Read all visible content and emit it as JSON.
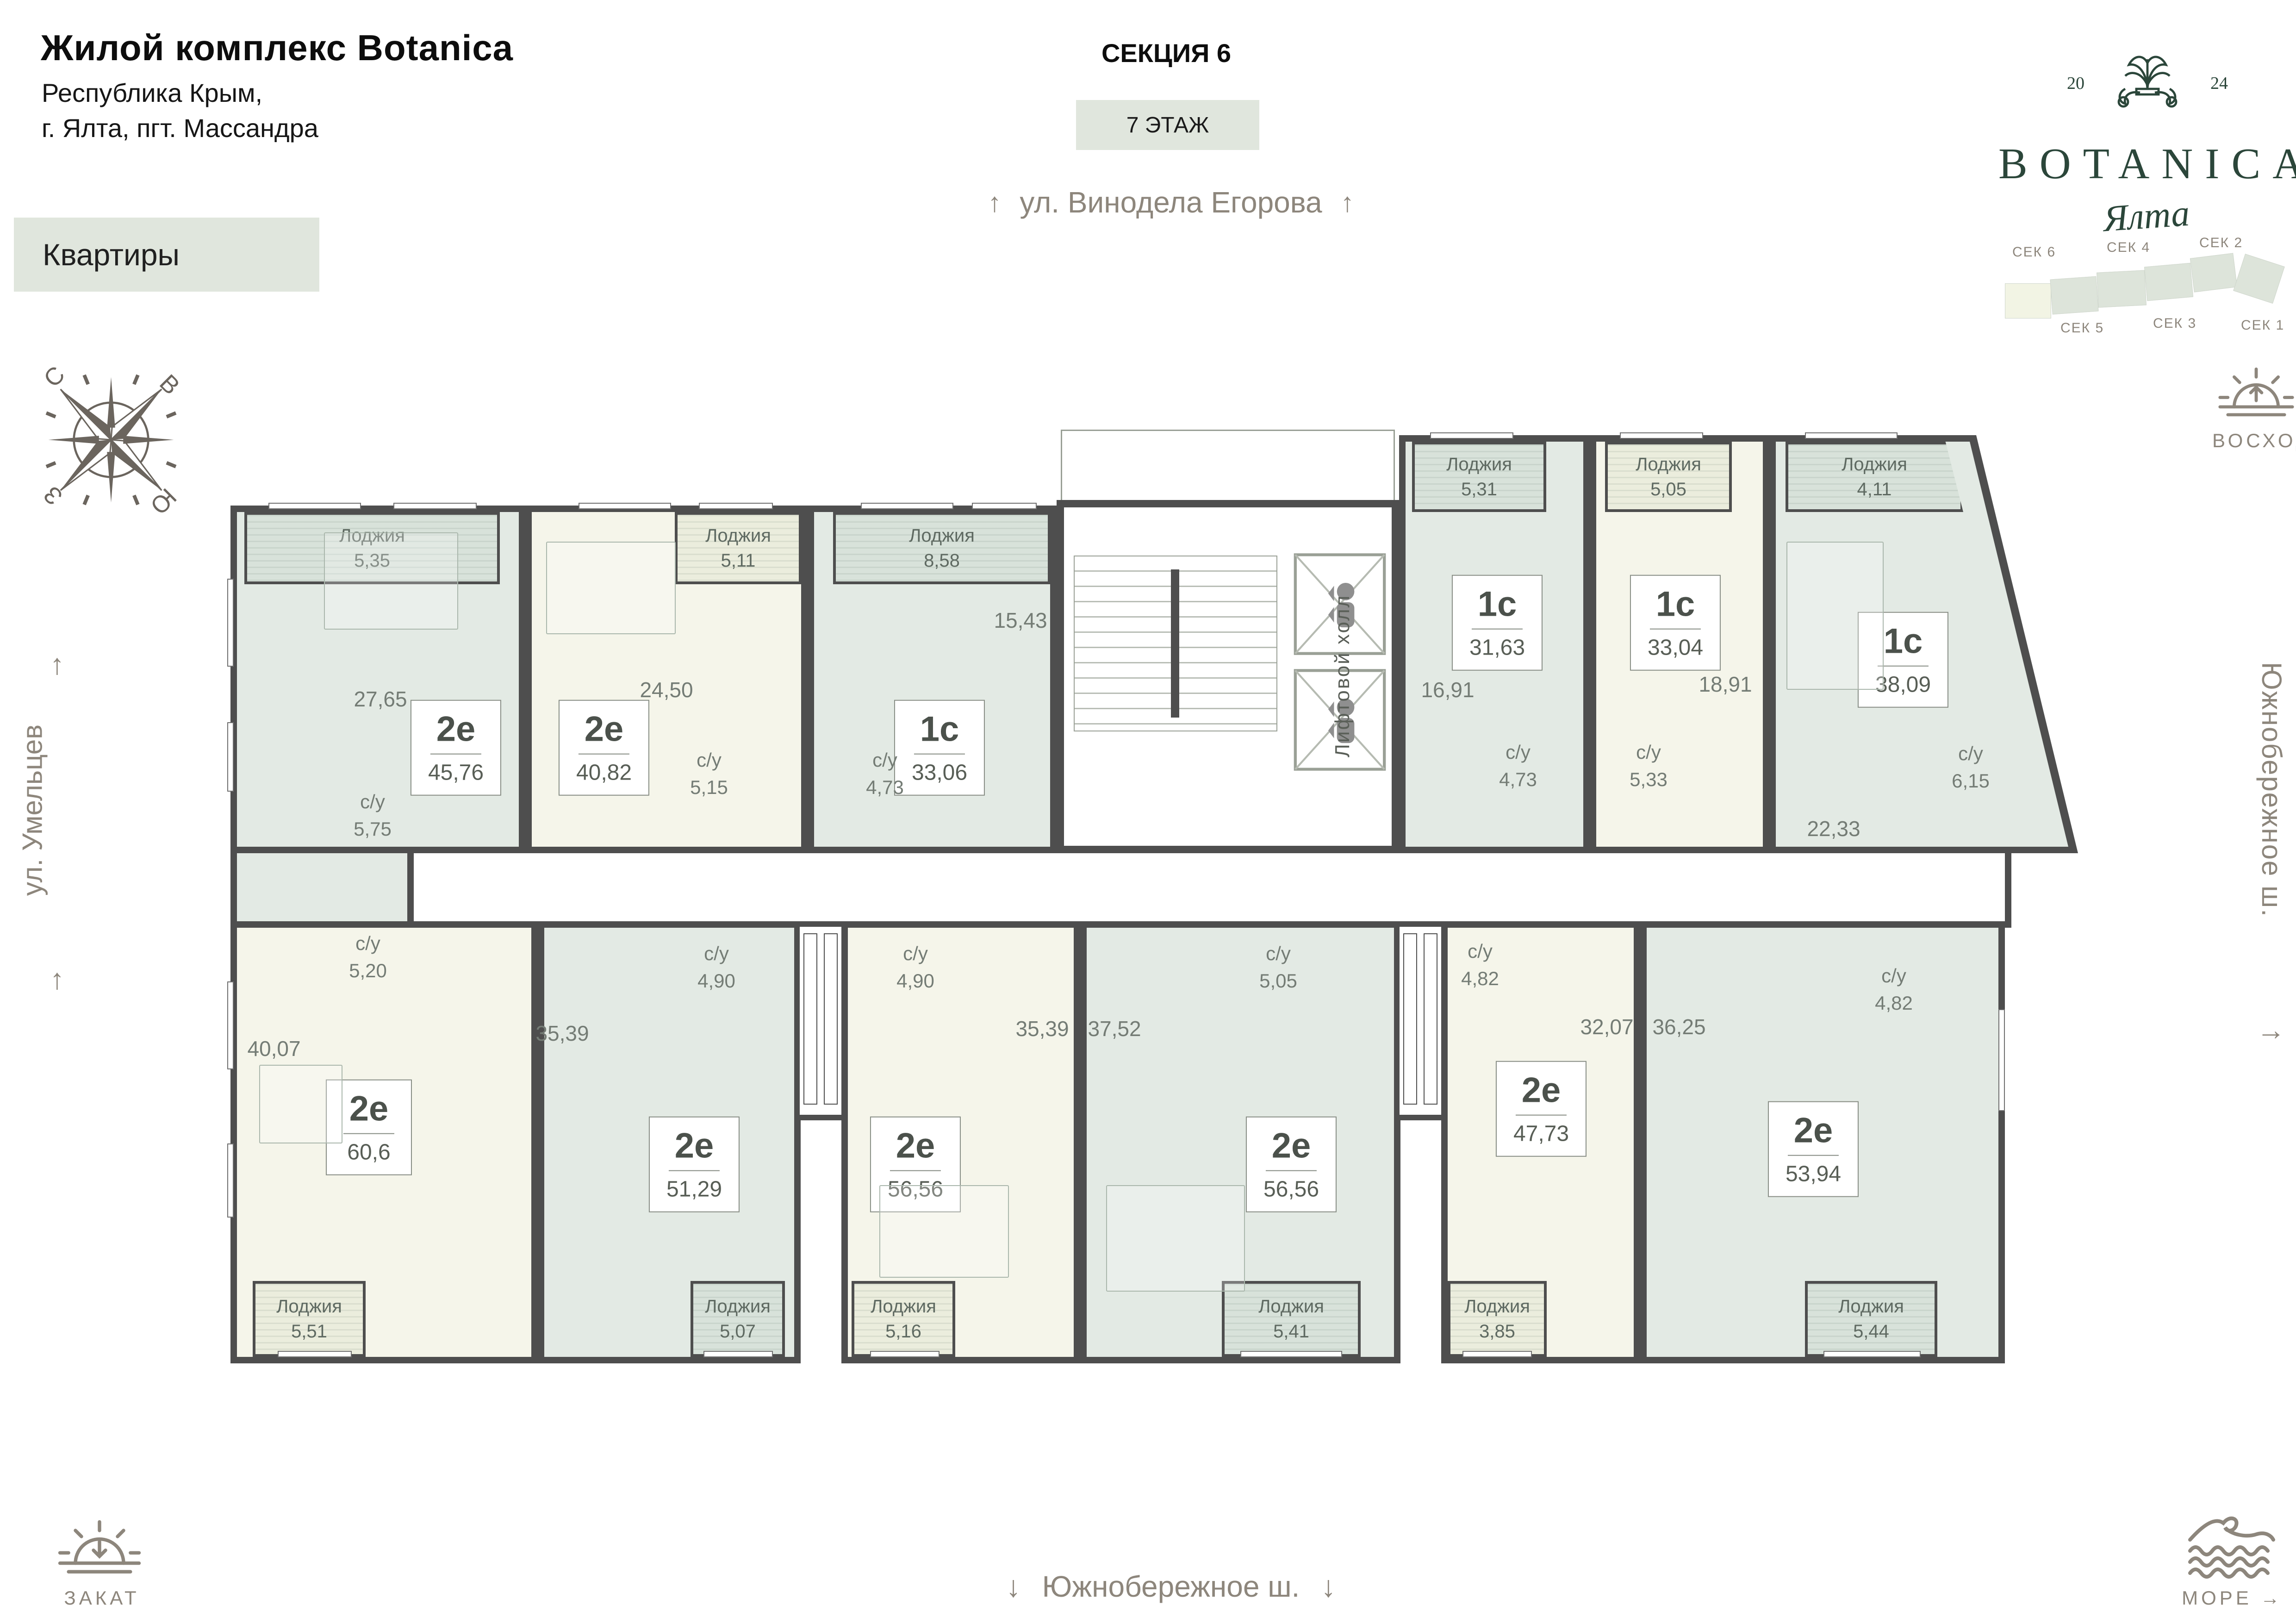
{
  "header": {
    "title": "Жилой комплекс Botanica",
    "address_line1": "Республика Крым,",
    "address_line2": "г. Ялта, пгт. Массандра",
    "apartments_chip": "Квартиры",
    "section_title": "СЕКЦИЯ 6",
    "floor_label": "7 ЭТАЖ"
  },
  "logo": {
    "year_left": "20",
    "year_right": "24",
    "brand": "BOTANICA",
    "city_script": "Ялта"
  },
  "section_map": {
    "top_labels": [
      "СЕК 6",
      "СЕК 4",
      "СЕК 2"
    ],
    "bottom_labels": [
      "СЕК 5",
      "СЕК 3",
      "СЕК 1"
    ]
  },
  "streets": {
    "top": "ул. Винодела Егорова",
    "left": "ул. Умельцев",
    "right": "Южнобережное ш.",
    "bottom": "Южнобережное ш."
  },
  "landmarks": {
    "sunrise": "ВОСХОД",
    "sunset": "ЗАКАТ",
    "sea": "МОРЕ"
  },
  "compass": {
    "north": "С",
    "east": "В",
    "west": "З",
    "south": "Ю"
  },
  "icons": {
    "arrow_up": "↑",
    "arrow_down": "↓",
    "arrow_right": "→"
  },
  "core": {
    "elevator_hall": "Лифтовой холл"
  },
  "labels": {
    "su": "с/у",
    "loggia": "Лоджия"
  },
  "apartments": [
    {
      "type": "2е",
      "area": "45,76",
      "room": "27,65",
      "su": "5,75",
      "loggia": "5,35"
    },
    {
      "type": "2е",
      "area": "40,82",
      "room": "24,50",
      "su": "5,15",
      "loggia": "5,11"
    },
    {
      "type": "1с",
      "area": "33,06",
      "room": "15,43",
      "su": "4,73",
      "loggia": "8,58"
    },
    {
      "type": "1с",
      "area": "31,63",
      "room": "16,91",
      "su": "4,73",
      "loggia": "5,31"
    },
    {
      "type": "1с",
      "area": "33,04",
      "room": "18,91",
      "su": "5,33",
      "loggia": "5,05"
    },
    {
      "type": "1с",
      "area": "38,09",
      "room": "22,33",
      "su": "6,15",
      "loggia": "4,11"
    },
    {
      "type": "2е",
      "area": "60,6",
      "room": "40,07",
      "su": "5,20",
      "loggia": "5,51"
    },
    {
      "type": "2е",
      "area": "51,29",
      "room": "35,39",
      "su": "4,90",
      "loggia": "5,07"
    },
    {
      "type": "2е",
      "area": "56,56",
      "room": "35,39",
      "su": "4,90",
      "loggia": "5,16"
    },
    {
      "type": "2е",
      "area": "56,56",
      "room": "37,52",
      "su": "5,05",
      "loggia": "5,41"
    },
    {
      "type": "2е",
      "area": "47,73",
      "room": "32,07",
      "su": "4,82",
      "loggia": "3,85"
    },
    {
      "type": "2е",
      "area": "53,94",
      "room": "36,25",
      "su": "4,82",
      "loggia": "5,44"
    }
  ],
  "colors": {
    "wall": "#4e4e4e",
    "apartment_green": "#e3eae4",
    "apartment_cream": "#f5f5ea",
    "chip_bg": "#e0e6dd",
    "brand_green": "#2b463a",
    "label_gray": "#8d867c"
  }
}
